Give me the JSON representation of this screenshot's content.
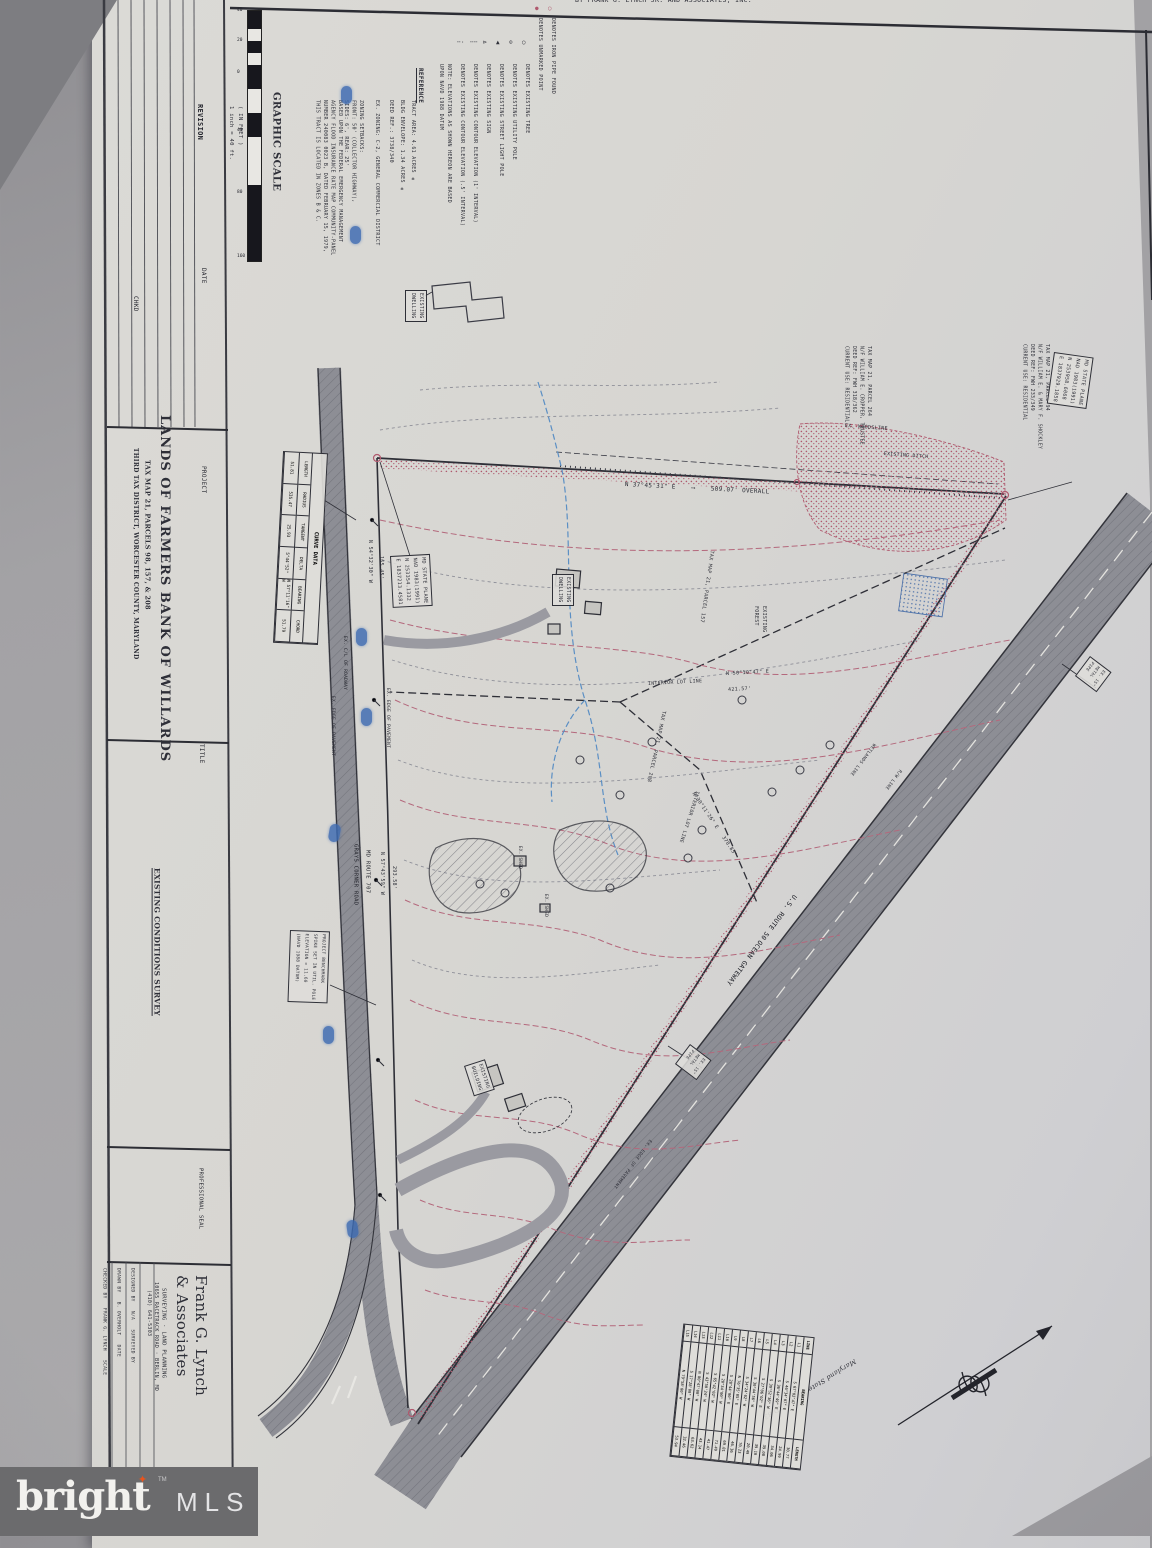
{
  "photo": {
    "top_note": "BY FRANK G. LYNCH JR. AND ASSOCIATES, INC."
  },
  "watermark": {
    "brand": "bright",
    "star": "✦",
    "tm": "TM",
    "mls": "MLS",
    "bar_color": "#6b6b6d",
    "star_color": "#e8541d"
  },
  "titleblock": {
    "revision_header": "REVISION",
    "date_header": "DATE",
    "chkd_header": "CHKD",
    "project_label": "PROJECT",
    "project_name": "LANDS OF FARMERS BANK OF WILLARDS",
    "project_line2": "TAX MAP 21, PARCELS 98, 157, & 208",
    "project_line3": "THIRD TAX DISTRICT, WORCESTER COUNTY, MARYLAND",
    "title_label": "TITLE",
    "title_name": "EXISTING CONDITIONS SURVEY",
    "seal_label": "PROFESSIONAL SEAL",
    "firm_name": "Frank G. Lynch\n& Associates",
    "firm_services": "SURVEYING · LAND PLANNING",
    "firm_address": "10655 RACETRACK ROAD · BERLIN, MD",
    "firm_phone": "(410) 641-5303",
    "firm_col1": "CHECKED BY   FRANK G. LYNCH   SCALE",
    "firm_col2": "DRAWN BY   B. OVERHOLT   DATE",
    "firm_col3": "DESIGNED BY   N/A   SURVEYED BY"
  },
  "scalebar": {
    "title": "GRAPHIC SCALE",
    "units_note": "( IN FEET )\n1 inch = 40 ft.",
    "ticks": [
      "40",
      "20",
      "0",
      "40",
      "80",
      "160"
    ]
  },
  "legend": {
    "items": [
      {
        "sym": "iron-pipe",
        "glyph": "○",
        "text": "DENOTES IRON PIPE FOUND"
      },
      {
        "sym": "unmarked-point",
        "glyph": "●",
        "text": "DENOTES UNMARKED POINT"
      },
      {
        "sym": "tree",
        "glyph": "○",
        "text": "DENOTES EXISTING TREE"
      },
      {
        "sym": "utility-pole",
        "glyph": "⊙",
        "text": "DENOTES EXISTING UTILITY POLE"
      },
      {
        "sym": "street-light",
        "glyph": "▲",
        "text": "DENOTES EXISTING STREET LIGHT POLE"
      },
      {
        "sym": "sign",
        "glyph": "⊳",
        "text": "DENOTES EXISTING SIGN"
      },
      {
        "sym": "contour-1ft",
        "glyph": "╌╌",
        "text": "DENOTES EXISTING CONTOUR ELEVATION (1' INTERVAL)"
      },
      {
        "sym": "contour-half-ft",
        "glyph": "╌·",
        "text": "DENOTES EXISTING CONTOUR ELEVATION (.5' INTERVAL)"
      },
      {
        "sym": "note",
        "glyph": "",
        "text": "NOTE: ELEVATIONS AS SHOWN HEREON ARE BASED\nUPON NAVD 1988 DATUM"
      }
    ]
  },
  "reference": {
    "header": "REFERENCE",
    "items": [
      "TRACT AREA: 4.61 ACRES ±",
      "BLDG ENVELOPE: 1.34 ACRES ±",
      "DEED REF.: 3738/340",
      "EX. ZONING: C-2, GENERAL COMMERCIAL DISTRICT",
      "ZONING SETBACKS:\nFRONT: 50' (COLLECTOR HIGHWAY),\nSIDES: 6', REAR: 25'",
      "BASED UPON THE FEDERAL EMERGENCY MANAGEMENT\nAGENCY FLOOD INSURANCE RATE MAP COMMUNITY-PANEL\nNUMBER 240083 0023 B, DATED FEBRUARY 15, 1979,\nTHIS TRACT IS LOCATED IN ZONES B & C."
    ]
  },
  "curve_table": {
    "title": "CURVE DATA",
    "labels": [
      "LENGTH",
      "RADIUS",
      "TANGENT",
      "DELTA",
      "BEARING",
      "CHORD"
    ],
    "values": [
      "51.81",
      "535.47",
      "25.93",
      "5°44'52\"",
      "N 57°11'16\" W",
      "51.79"
    ]
  },
  "wetlands_table": {
    "headers": [
      "LINE",
      "BEARING",
      "LENGTH"
    ],
    "rows": [
      [
        "L1",
        "S 67°02'47\" E",
        "30.77"
      ],
      [
        "L2",
        "S 46°34'07\" E",
        "24.99"
      ],
      [
        "L3",
        "S 36°44'49\" E",
        "34.06"
      ],
      [
        "L4",
        "S 39°52'36\" W",
        "39.08"
      ],
      [
        "L5",
        "S 27°06'02\" E",
        "39.10"
      ],
      [
        "L6",
        "S 30°44'56\" W",
        "20.49"
      ],
      [
        "L7",
        "S 34°24'02\" W",
        "70.23"
      ],
      [
        "L8",
        "N 76°35'05\" E",
        "46.36"
      ],
      [
        "L9",
        "S 28°44'00\" E",
        "69.81"
      ],
      [
        "L10",
        "S 20°34'00\" W",
        "71.49"
      ],
      [
        "L11",
        "S 65°42'02\" W",
        "41.47"
      ],
      [
        "L12",
        "S 43°50'24\" W",
        "43.14"
      ],
      [
        "L13",
        "N 80°47'00\" W",
        "63.62"
      ],
      [
        "L14",
        "S 17°28'00\" W",
        "32.46"
      ],
      [
        "L15",
        "N 79°58'00\" W",
        "53.94"
      ]
    ]
  },
  "north_arrow": {
    "label": "Maryland State Plane NAD 83"
  },
  "map": {
    "boundary_top_1": "420.58'  TO  WETLANDS",
    "boundary_top_2": "N 37°45'31\" E    ⟶    509.07' OVERALL",
    "ex_woodsline": "EX. WOODSLINE",
    "existing_ditch": "EXISTING DITCH",
    "parcel264": "TAX MAP 21, PARCEL 264\nN/F WILLIAM E. CROPPER, TRUSTEE\nDEED REF: FWH 318/362\nCURRENT USE: RESIDENTIAL",
    "parcel94": "TAX MAP 21, PARCEL 94\nN/F WILLIAM E. & MARY F. SHOCKLEY\nDEED REF: FWH 233/349\nCURRENT USE: RESIDENTIAL",
    "stateplane_ne": "MD STATE PLANE\nNAD 1983(1991)\nN 253958.6068\nE 1837929.1858",
    "stateplane_w": "MD STATE PLANE\nNAD 1983(1991)\nN 253354.1332\nE 1837213.4581",
    "parcel157": "TAX MAP 21, PARCEL 157",
    "parcel208": "TAX MAP 21, PARCEL 208",
    "existing_forest": "EXISTING\nFOREST",
    "interior_lot_line": "INTERIOR LOT LINE",
    "bearing_int1": "N 50°10'47\" E",
    "dist_int1": "421.57'",
    "bearing_int2": "N 30°11'26\" E   378.85'",
    "bearing_left1": "N 54°32'30\" W",
    "dist_left1": "165.45'",
    "bearing_left2": "N 57°43'59\" W",
    "dist_left2": "293.58'",
    "grays_corner_road": "GRAYS CORNER ROAD",
    "md_route_707": "MD ROUTE 707",
    "us_route_50": "U.S. ROUTE 50",
    "ocean_gateway": "OCEAN GATEWAY",
    "ex_cl_roadway": "EX. C/L OF ROADWAY",
    "ex_edge_pavement": "EX. EDGE OF PAVEMENT",
    "wetlands_line": "WETLANDS LINE",
    "rw_line": "R/W LINE",
    "benchmark": "PROJECT BENCHMARK\nSPIKE SET IN UTIL. POLE\nELEVATION = 11.60\n(NAVD 1988 DATUM)",
    "existing_dwelling": "EXISTING\nDWELLING",
    "existing_building": "EXISTING\nBUILDING",
    "ex_shed": "EX. SHED",
    "metal_pipe": "EX. 15\"\nMETAL\nPIPE"
  }
}
